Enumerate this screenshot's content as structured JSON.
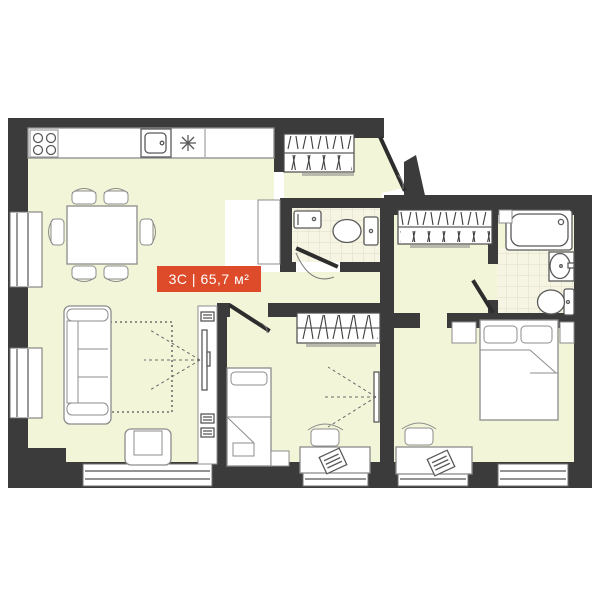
{
  "label": {
    "text": "3С | 65,7 м²"
  },
  "colors": {
    "bg": "#ffffff",
    "wall": "#3b3b3b",
    "floor": "#f3f5d8",
    "tile": "#f6f5e3",
    "tileLine": "#d8d5bb",
    "line": "#8c8c8c",
    "fixture": "#5a5a5a",
    "door": "#2d2d2d",
    "accent": "#dd4b2a",
    "accentText": "#ffffff"
  }
}
